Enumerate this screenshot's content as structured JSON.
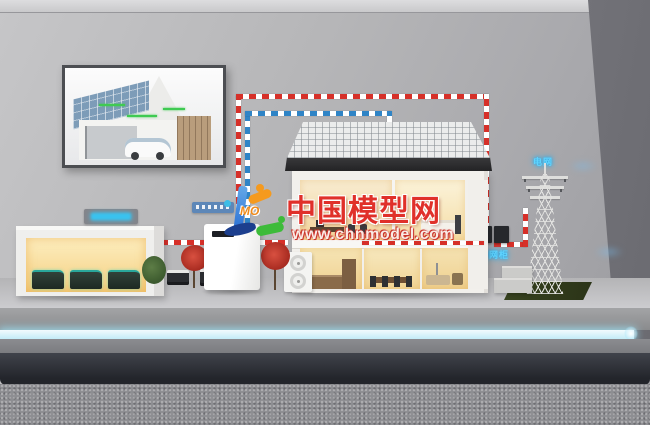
{
  "watermark": {
    "brand": "中国模型网",
    "url": "www.chnmodel.com",
    "logo_text": "MO",
    "brand_color": "#e0302a"
  },
  "labels": {
    "grid_cabinet_sign": "并网柜",
    "power_grid_sign": "电网"
  },
  "colors": {
    "tape_red": "#d63029",
    "tape_blue": "#2f84c6",
    "led_strip": "#dff6fb",
    "glow_blue": "#39c2ef",
    "grass": "#323d1c",
    "solar_poster_roof": "#7d9cb8"
  }
}
